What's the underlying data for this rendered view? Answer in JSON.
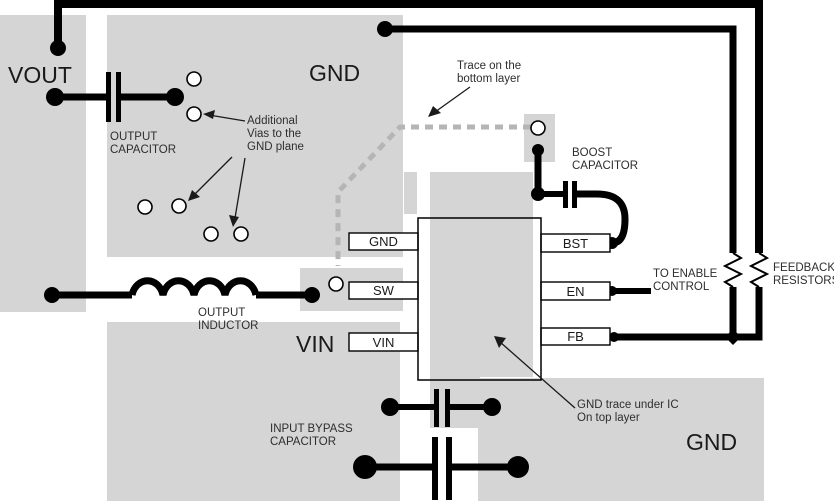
{
  "figure": {
    "type": "pcb-layout-diagram",
    "colors": {
      "copper_plane": "#d5d5d5",
      "top_layer_trace": "#000000",
      "bottom_layer_trace": "#b5b5b5",
      "text": "#1a1a1a",
      "background": "#ffffff"
    }
  },
  "plane_labels": {
    "vout": "VOUT",
    "gnd_top": "GND",
    "vin": "VIN",
    "gnd_bottom": "GND"
  },
  "ic": {
    "pins_left": [
      "GND",
      "SW",
      "VIN"
    ],
    "pins_right": [
      "BST",
      "EN",
      "FB"
    ]
  },
  "annotations": {
    "output_capacitor": [
      "OUTPUT",
      "CAPACITOR"
    ],
    "additional_vias": [
      "Additional",
      "Vias to the",
      "GND plane"
    ],
    "trace_bottom_layer": [
      "Trace on the",
      "bottom layer"
    ],
    "boost_capacitor": [
      "BOOST",
      "CAPACITOR"
    ],
    "to_enable_control": [
      "TO ENABLE",
      "CONTROL"
    ],
    "feedback_resistors": [
      "FEEDBACK",
      "RESISTORS"
    ],
    "output_inductor": [
      "OUTPUT",
      "INDUCTOR"
    ],
    "input_bypass_capacitor": [
      "INPUT BYPASS",
      "CAPACITOR"
    ],
    "gnd_trace_under_ic": [
      "GND trace under IC",
      "On top layer"
    ]
  }
}
